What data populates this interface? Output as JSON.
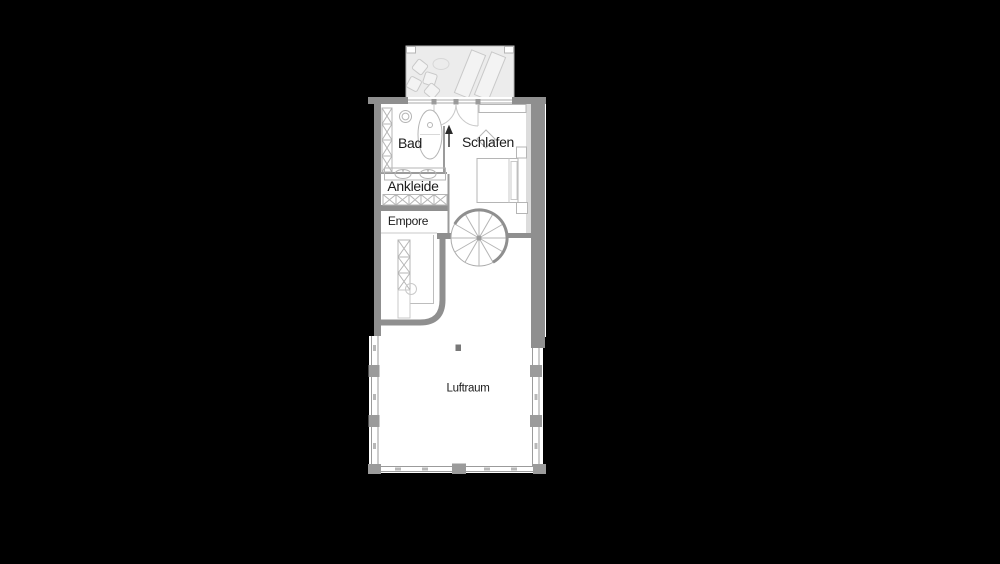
{
  "plan": {
    "rooms": [
      {
        "id": "bad",
        "label": "Bad"
      },
      {
        "id": "schlafen",
        "label": "Schlafen"
      },
      {
        "id": "ankleide",
        "label": "Ankleide"
      },
      {
        "id": "empore",
        "label": "Empore"
      },
      {
        "id": "luftraum",
        "label": "Luftraum"
      }
    ],
    "colors": {
      "bg": "#000000",
      "floor": "#ffffff",
      "wall": "#8f8f8f",
      "wall_light": "#dcdcdc",
      "line": "#9b9b9b",
      "fixture": "#b5b5b5",
      "balcony": "#ececec",
      "text": "#1c1c1c",
      "dark": "#787878"
    }
  }
}
